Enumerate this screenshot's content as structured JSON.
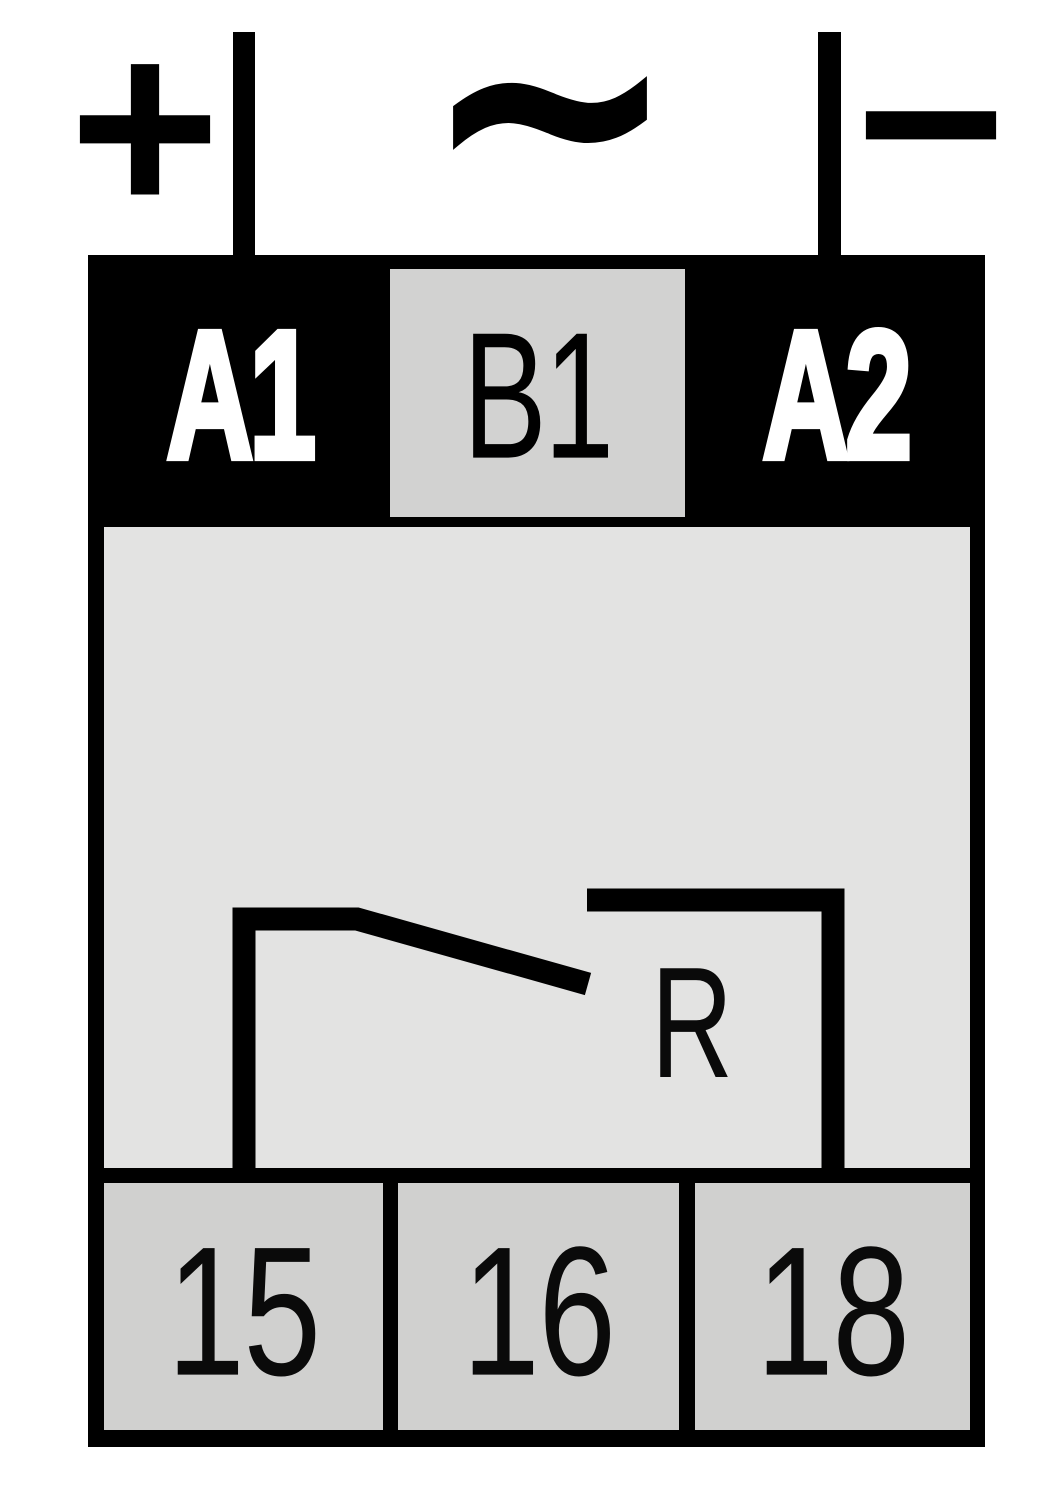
{
  "diagram": {
    "type": "relay-terminal-wiring-diagram",
    "top_symbols": {
      "plus": "+",
      "ac": "~",
      "minus": "−"
    },
    "coil_terminals": {
      "a1": "A1",
      "b1": "B1",
      "a2": "A2"
    },
    "relay_label": "R",
    "output_terminals": {
      "t15": "15",
      "t16": "16",
      "t18": "18"
    },
    "colors": {
      "line": "#000000",
      "background": "#ffffff",
      "device_body": "#e3e3e2",
      "b1_box": "#d2d2d1",
      "output_box": "#d0d0cf",
      "coil_label_text": "#ffffff"
    }
  }
}
